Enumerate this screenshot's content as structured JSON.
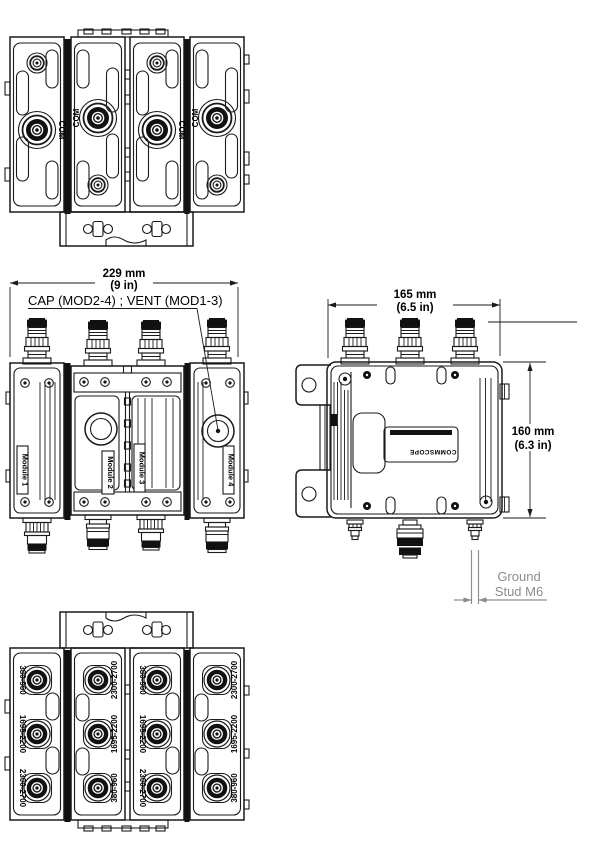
{
  "title": "RF multiband combiner module assembly drawing",
  "colors": {
    "line": "#1a1a1a",
    "annotation_gray": "#8d8d8d"
  },
  "top_view": {
    "com_labels": [
      "COM",
      "COM",
      "COM",
      "COM"
    ]
  },
  "front_view": {
    "dim_width": "229 mm",
    "dim_width_in": "(9 in)",
    "callout": "CAP (MOD2-4) ; VENT (MOD1-3)",
    "module_labels": [
      "Module 1",
      "Module 2",
      "Module 3",
      "Module 4"
    ]
  },
  "side_view": {
    "dim_width": "165 mm",
    "dim_width_in": "(6.5 in)",
    "dim_height": "160 mm",
    "dim_height_in": "(6.3 in)",
    "ground_line1": "Ground",
    "ground_line2": "Stud M6",
    "brand": "COMMSCOPE"
  },
  "bottom_view": {
    "col1": [
      "380-960",
      "1695-2200",
      "2300-2700"
    ],
    "col2": [
      "2300-2700",
      "1695-2200",
      "380-960"
    ],
    "col3": [
      "380-960",
      "1695-2200",
      "2300-2700"
    ],
    "col4": [
      "2300-2700",
      "1695-2200",
      "380-960"
    ]
  }
}
